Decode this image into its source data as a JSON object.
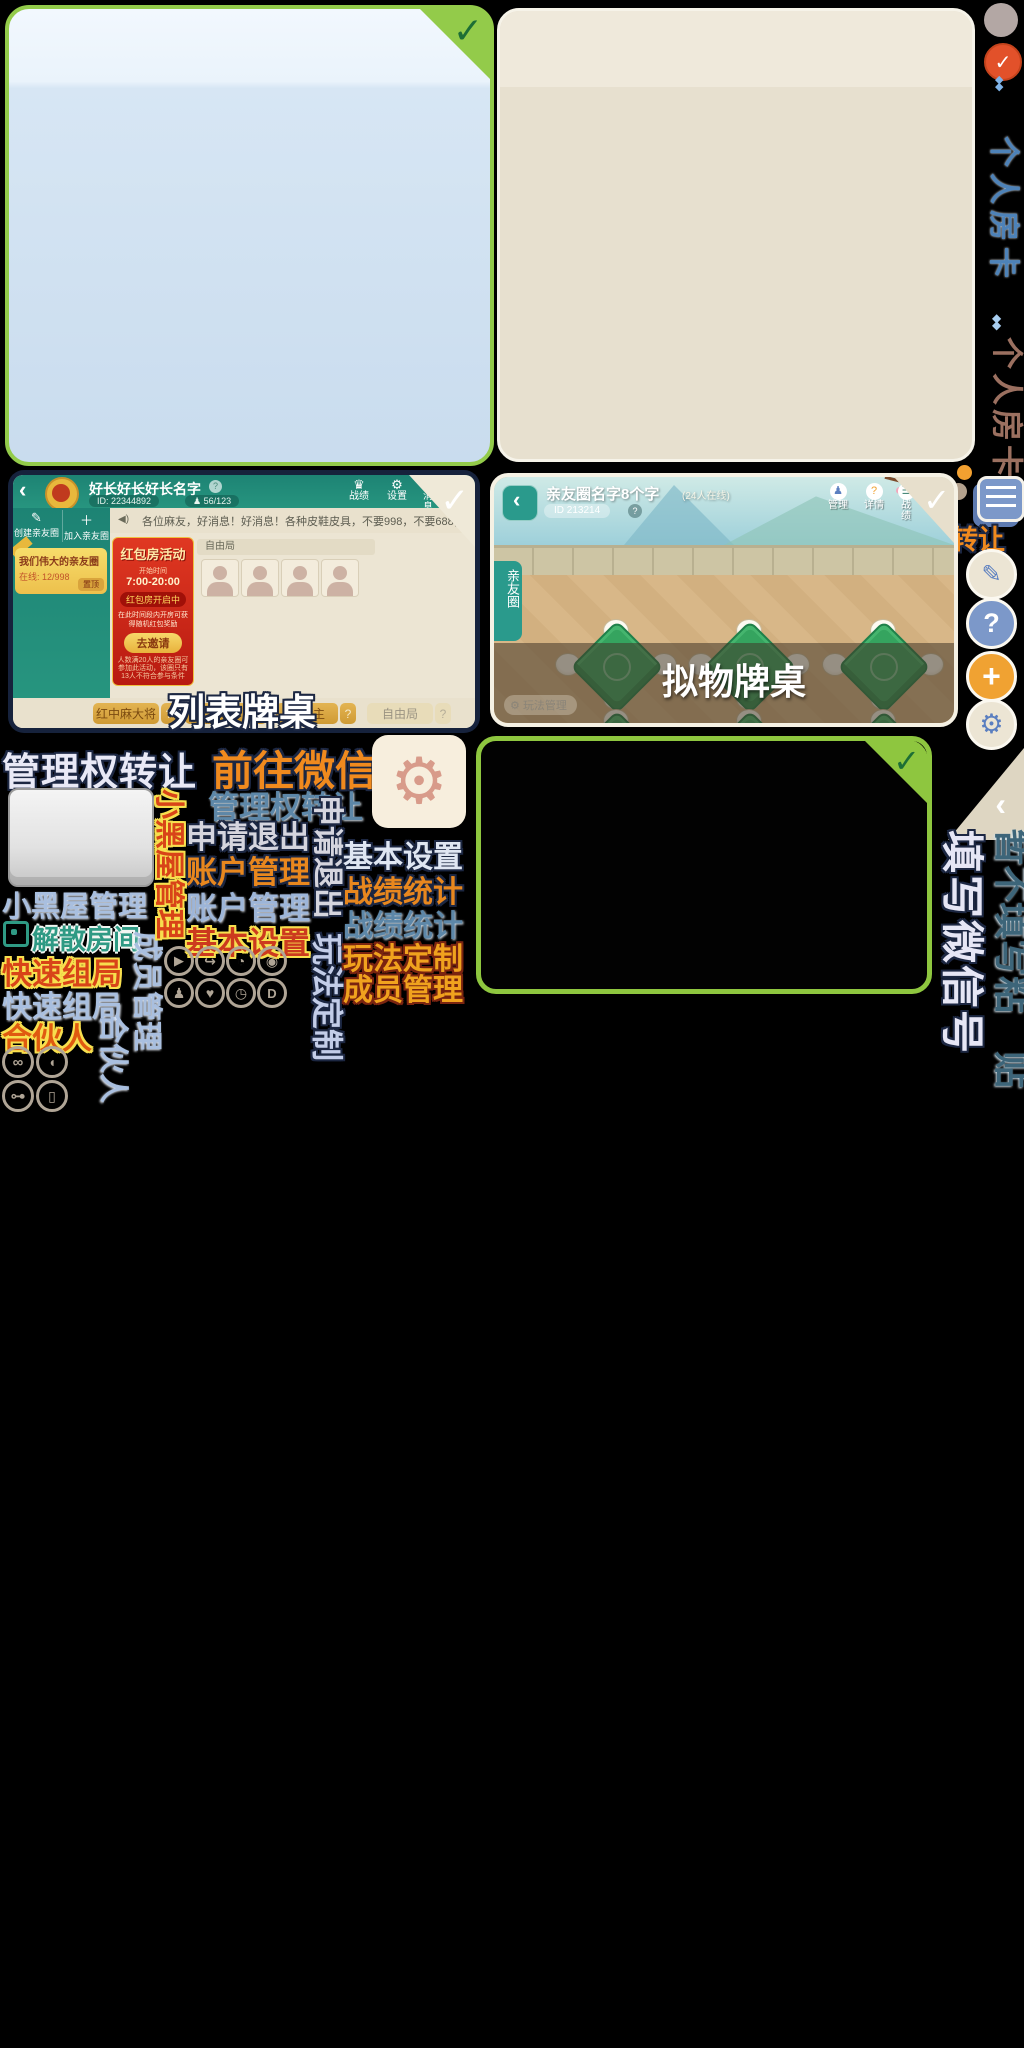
{
  "colors": {
    "accent_green": "#8ec63f",
    "check_green": "#1d6e35",
    "teal_header": "#1d8374",
    "orange_text": "#f08a1e",
    "steel_blue": "#5d87a8",
    "light_blue_text": "#a9bfdf",
    "red_text": "#cc3a1e",
    "radio_selected": "#e2512a"
  },
  "right_rail": {
    "radio_check_glyph": "✓",
    "diamond_glyph": "◆◆",
    "tab_personal_blue": "个人房卡",
    "tab_personal_brown": "个人房卡",
    "transfer_label": "转让",
    "skip_label": "暂不填写",
    "paste_label": "粘贴",
    "fill_wechat_label": "填写微信号",
    "pencil_glyph": "✎",
    "question_glyph": "?",
    "plus_glyph": "+",
    "gear_glyph": "⚙",
    "collapse_chevron_glyph": "‹"
  },
  "list_room": {
    "big_label": "列表牌桌",
    "back_glyph": "‹",
    "title": "好长好长好长名字",
    "help_glyph": "?",
    "room_id": "ID: 22344892",
    "person_glyph": "♟",
    "members": "56/123",
    "trophy_glyph": "♛",
    "gear_glyph": "⚙",
    "action_stats": "战绩",
    "action_settings": "设置",
    "action_message": "消息",
    "check_glyph": "✓",
    "speaker_glyph": "◀)",
    "announcement": "各位麻友，好消息！好消息！各种皮鞋皮具，不要998，不要688，只要98元，只…",
    "create_glyph": "✎",
    "sidebar_create": "创建亲友圈",
    "join_glyph": "＋",
    "sidebar_join": "加入亲友圈",
    "circle_name": "我们伟大的亲友圈",
    "circle_online": "在线: 12/998",
    "circle_chip": "置顶",
    "banner_title": "红包房活动",
    "banner_time_label": "开始时间",
    "banner_time": "7:00-20:00",
    "banner_status": "红包房开启中",
    "banner_desc": "在此时间段内开房可获得随机红包奖励",
    "banner_button": "去邀请",
    "banner_note": "人数满20人的亲友圈可参加此活动，该圈只有13人不符合参与条件",
    "section_title": "自由局",
    "tabs": [
      {
        "label": "红中麻大将",
        "help": "?"
      },
      {
        "label": "三丁两房",
        "help": "?"
      },
      {
        "label": "斗地主",
        "help": "?"
      },
      {
        "label": "自由局",
        "help": "?"
      }
    ]
  },
  "object_room": {
    "big_label": "拟物牌桌",
    "back_glyph": "‹",
    "title": "亲友圈名字8个字",
    "subtitle": "(24人在线)",
    "room_id": "ID 213214",
    "help_glyph": "?",
    "person_glyph": "♟",
    "question_glyph": "?",
    "list_glyph": "☰",
    "action_manage": "管理",
    "action_detail": "详情",
    "action_stats": "战绩",
    "check_glyph": "✓",
    "side_tab": "亲友圈",
    "gear_glyph": "⚙",
    "manage_pill": "玩法管理"
  },
  "sprite_labels": {
    "manage_transfer_white": "管理权转让",
    "goto_wechat": "前往微信",
    "gear_glyph": "⚙",
    "manage_transfer_blue": "管理权转让",
    "apply_exit": "申请退出",
    "account_manage_orange": "账户管理",
    "account_manage_blue": "账户管理",
    "basic_settings_red": "基本设置",
    "blackroom_manage_blue": "小黑屋管理",
    "blackroom_manage_red": "小黑屋管理",
    "dismiss_room": "解散房间",
    "quick_group_red": "快速组局",
    "quick_group_blue": "快速组局",
    "partner_orange": "合伙人",
    "partner_blue": "合伙人",
    "member_manage_blue": "成员管理",
    "apply_exit_gray": "申请退出",
    "play_custom_lavender": "玩法定制",
    "basic_settings_white": "基本设置",
    "stats_orange": "战绩统计",
    "stats_blue": "战绩统计",
    "play_custom_gold": "玩法定制",
    "member_manage_gold": "成员管理"
  },
  "icon_rows": {
    "row1": [
      "▶",
      "↪",
      "◔",
      "◉"
    ],
    "row2": [
      "♟",
      "♥",
      "◷",
      "D"
    ],
    "grid": [
      "∞",
      "◖",
      "⊶",
      "▯"
    ]
  }
}
